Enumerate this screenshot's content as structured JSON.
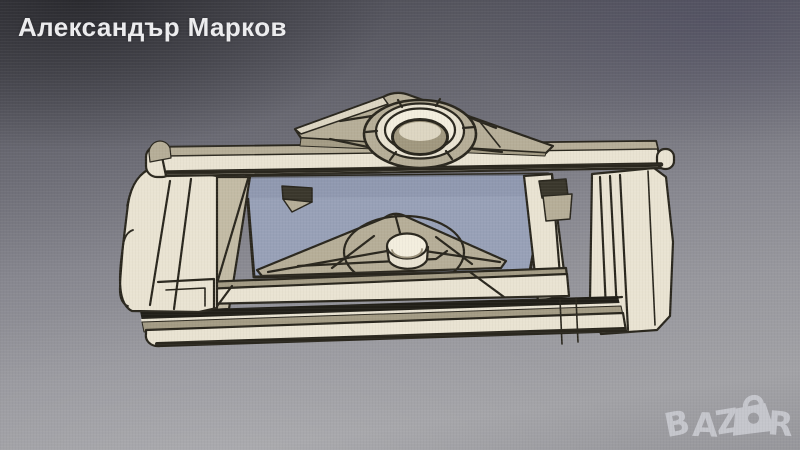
{
  "screen_photo": {
    "seller_name": "Александър Марков",
    "watermark": {
      "prefix": "BAZ",
      "suffix": "R",
      "icon": "shopping-bag-icon"
    },
    "viewport": {
      "content_label": "beige 3D CAD bracket model with triangular gussets and circular boss",
      "colors": {
        "model_cream": "#e9e3d2",
        "model_cream_bright": "#f3eede",
        "model_tan": "#b6ae98",
        "model_tan_dark": "#a49c85",
        "edge_outline": "#2a271e",
        "through_opening_blue": "#98a1b7",
        "screen_gradient_top": "#46464e",
        "screen_gradient_bottom": "#a2a2a6",
        "watermark_gray": "#c9cad0",
        "seller_text_white": "#ededef"
      }
    }
  }
}
